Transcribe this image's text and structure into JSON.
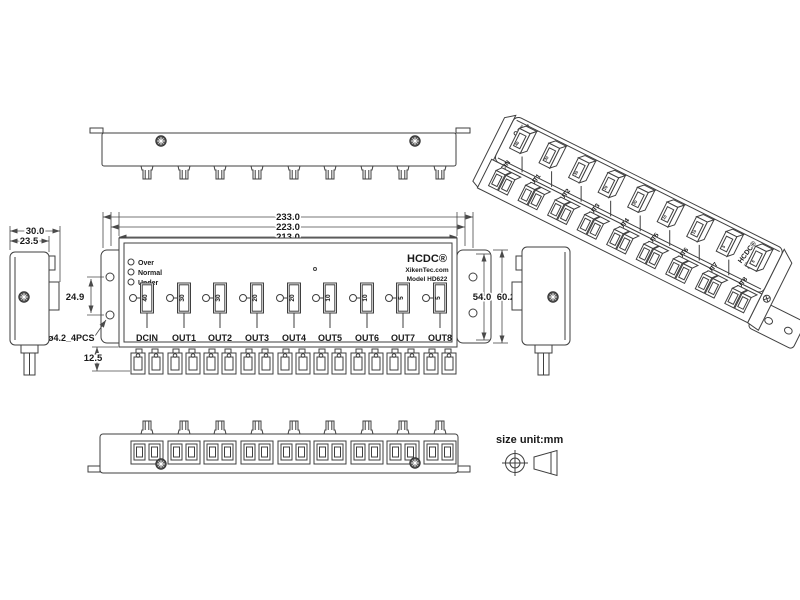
{
  "drawing": {
    "brand": "HCDC®",
    "website": "XikenTec.com",
    "model": "Model HD622",
    "note": "size unit:mm",
    "leds": [
      "Over",
      "Normal",
      "Under"
    ],
    "ports": [
      "DCIN",
      "OUT1",
      "OUT2",
      "OUT3",
      "OUT4",
      "OUT5",
      "OUT6",
      "OUT7",
      "OUT8"
    ],
    "fuses": [
      "40",
      "30",
      "30",
      "20",
      "20",
      "10",
      "10",
      "5",
      "5"
    ],
    "dimensions": {
      "overall_width": "233.0",
      "mid_width": "223.0",
      "body_width": "213.0",
      "side_depth": "30.0",
      "side_body_depth": "23.5",
      "mount_hole_pitch": "24.9",
      "mount_hole_note": "ø4.2_4PCS",
      "connector_height": "12.5",
      "flange_hole_span": "54.0",
      "flange_height": "60.2"
    },
    "line_color": "#3f3f3f"
  }
}
